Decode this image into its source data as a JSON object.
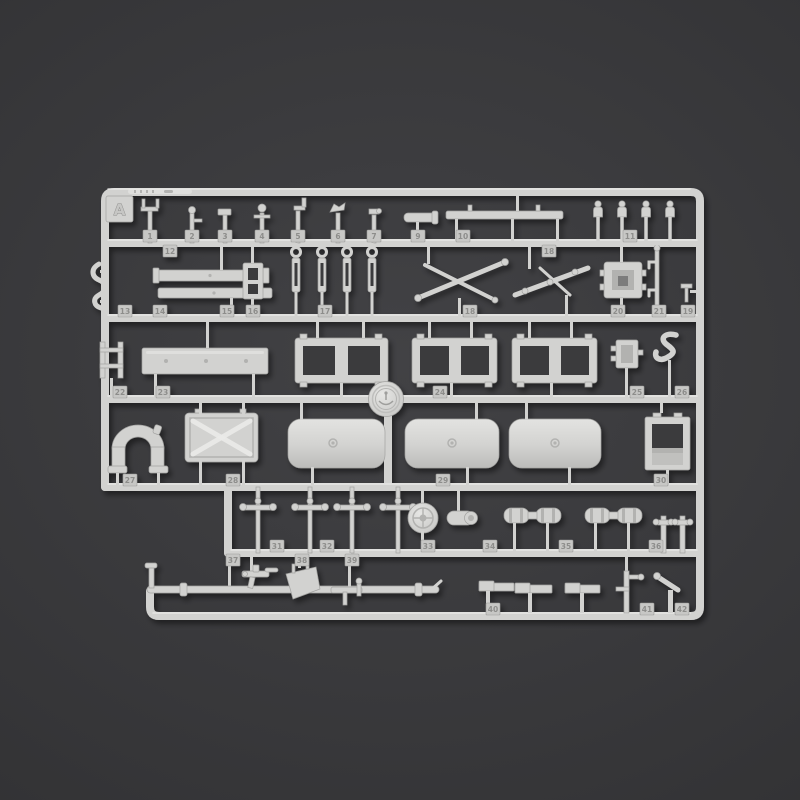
{
  "sprue": {
    "letter": "A",
    "part_tags": [
      {
        "n": "1",
        "x": 150,
        "y": 236
      },
      {
        "n": "2",
        "x": 192,
        "y": 236
      },
      {
        "n": "3",
        "x": 225,
        "y": 236
      },
      {
        "n": "4",
        "x": 262,
        "y": 236
      },
      {
        "n": "5",
        "x": 298,
        "y": 236
      },
      {
        "n": "6",
        "x": 338,
        "y": 236
      },
      {
        "n": "7",
        "x": 374,
        "y": 236
      },
      {
        "n": "9",
        "x": 418,
        "y": 236
      },
      {
        "n": "10",
        "x": 463,
        "y": 236
      },
      {
        "n": "11",
        "x": 630,
        "y": 236
      },
      {
        "n": "12",
        "x": 170,
        "y": 251
      },
      {
        "n": "18",
        "x": 549,
        "y": 251
      },
      {
        "n": "13",
        "x": 125,
        "y": 311
      },
      {
        "n": "14",
        "x": 160,
        "y": 311
      },
      {
        "n": "15",
        "x": 227,
        "y": 311
      },
      {
        "n": "16",
        "x": 253,
        "y": 311
      },
      {
        "n": "17",
        "x": 325,
        "y": 311
      },
      {
        "n": "18",
        "x": 470,
        "y": 311
      },
      {
        "n": "19",
        "x": 688,
        "y": 311
      },
      {
        "n": "20",
        "x": 618,
        "y": 311
      },
      {
        "n": "21",
        "x": 659,
        "y": 311
      },
      {
        "n": "22",
        "x": 120,
        "y": 392
      },
      {
        "n": "23",
        "x": 163,
        "y": 392
      },
      {
        "n": "24",
        "x": 440,
        "y": 392
      },
      {
        "n": "25",
        "x": 637,
        "y": 392
      },
      {
        "n": "26",
        "x": 682,
        "y": 392
      },
      {
        "n": "27",
        "x": 130,
        "y": 480
      },
      {
        "n": "28",
        "x": 233,
        "y": 480
      },
      {
        "n": "29",
        "x": 443,
        "y": 480
      },
      {
        "n": "30",
        "x": 661,
        "y": 480
      },
      {
        "n": "31",
        "x": 277,
        "y": 546
      },
      {
        "n": "32",
        "x": 327,
        "y": 546
      },
      {
        "n": "33",
        "x": 428,
        "y": 546
      },
      {
        "n": "34",
        "x": 490,
        "y": 546
      },
      {
        "n": "35",
        "x": 566,
        "y": 546
      },
      {
        "n": "36",
        "x": 656,
        "y": 546
      },
      {
        "n": "37",
        "x": 233,
        "y": 560
      },
      {
        "n": "38",
        "x": 302,
        "y": 560
      },
      {
        "n": "39",
        "x": 352,
        "y": 560
      },
      {
        "n": "40",
        "x": 493,
        "y": 609
      },
      {
        "n": "41",
        "x": 647,
        "y": 609
      },
      {
        "n": "42",
        "x": 682,
        "y": 609
      }
    ],
    "colors": {
      "background_center": "#424245",
      "background_edge": "#2c2c2e",
      "plastic": "#d2d2d0",
      "plastic_highlight": "#ebebe9",
      "plastic_edge": "#a2a2a0",
      "plastic_dark": "#b2b2b0",
      "recess": "#3a3a3c",
      "emboss": "#8d8d8b"
    }
  }
}
